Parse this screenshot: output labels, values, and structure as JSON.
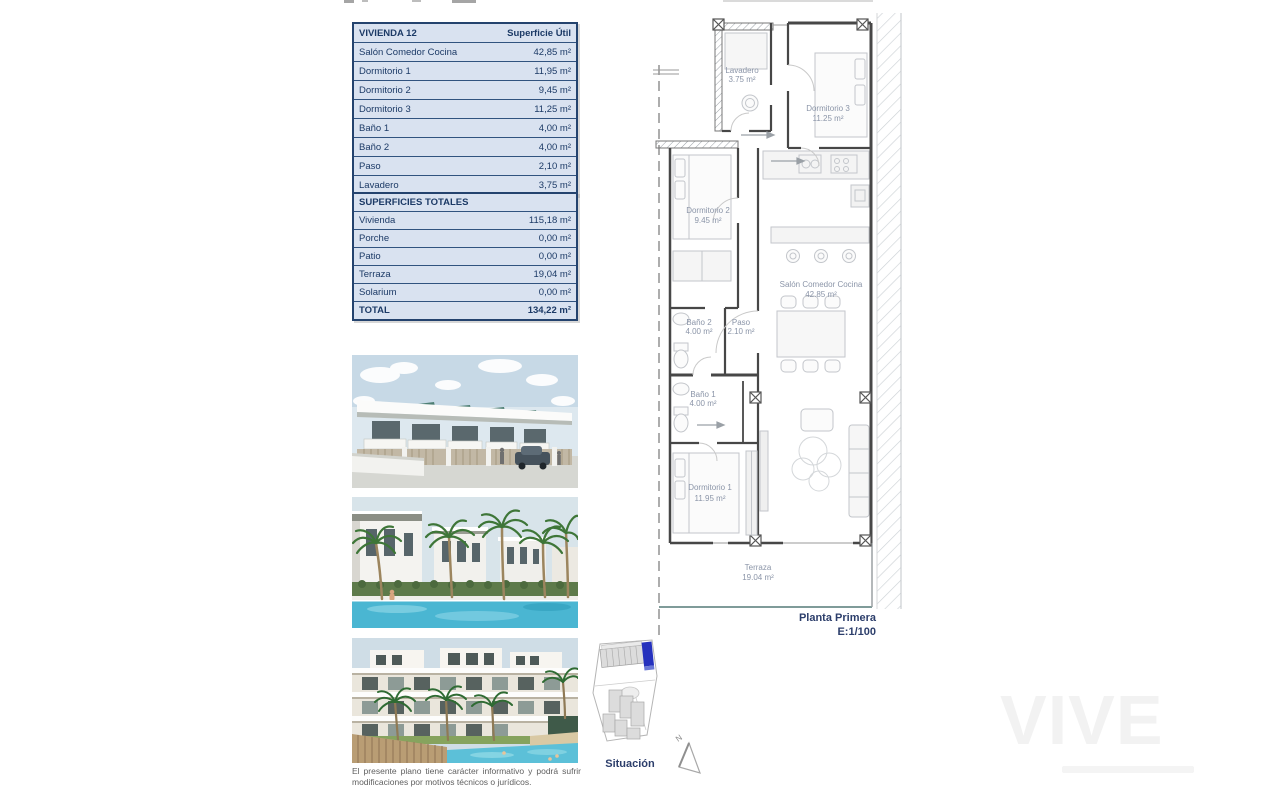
{
  "surface_table": {
    "title": "VIVIENDA 12",
    "header_right": "Superficie Útil",
    "rows": [
      {
        "label": "Salón Comedor Cocina",
        "value": "42,85 m²"
      },
      {
        "label": "Dormitorio 1",
        "value": "11,95 m²"
      },
      {
        "label": "Dormitorio 2",
        "value": "9,45 m²"
      },
      {
        "label": "Dormitorio 3",
        "value": "11,25 m²"
      },
      {
        "label": "Baño 1",
        "value": "4,00 m²"
      },
      {
        "label": "Baño 2",
        "value": "4,00 m²"
      },
      {
        "label": "Paso",
        "value": "2,10 m²"
      },
      {
        "label": "Lavadero",
        "value": "3,75 m²"
      }
    ]
  },
  "totals_table": {
    "title": "SUPERFICIES TOTALES",
    "rows": [
      {
        "label": "Vivienda",
        "value": "115,18 m²"
      },
      {
        "label": "Porche",
        "value": "0,00 m²"
      },
      {
        "label": "Patio",
        "value": "0,00 m²"
      },
      {
        "label": "Terraza",
        "value": "19,04 m²"
      },
      {
        "label": "Solarium",
        "value": "0,00 m²"
      }
    ],
    "total": {
      "label": "TOTAL",
      "value": "134,22 m²"
    }
  },
  "floorplan": {
    "rooms": [
      {
        "name": "Lavadero",
        "area": "3.75 m²"
      },
      {
        "name": "Dormitorio 3",
        "area": "11.25 m²"
      },
      {
        "name": "Dormitorio 2",
        "area": "9.45 m²"
      },
      {
        "name": "Salón Comedor Cocina",
        "area": "42.85 m²"
      },
      {
        "name": "Baño 2",
        "area": "4.00 m²"
      },
      {
        "name": "Paso",
        "area": "2.10 m²"
      },
      {
        "name": "Baño 1",
        "area": "4.00 m²"
      },
      {
        "name": "Dormitorio 1",
        "area": "11.95 m²"
      },
      {
        "name": "Terraza",
        "area": "19.04 m²"
      }
    ],
    "caption_line1": "Planta Primera",
    "caption_line2": "E:1/100"
  },
  "siteplan": {
    "label": "Situación",
    "compass": "N"
  },
  "disclaimer": "El presente plano tiene carácter informativo y podrá sufrir modificaciones por motivos técnicos o jurídicos.",
  "watermark": "VIVE",
  "colors": {
    "table_bg": "#d9e2f0",
    "table_border": "#24436e",
    "table_text": "#1c3a66",
    "plan_label": "#8b95a8",
    "site_highlight": "#2531bd"
  }
}
